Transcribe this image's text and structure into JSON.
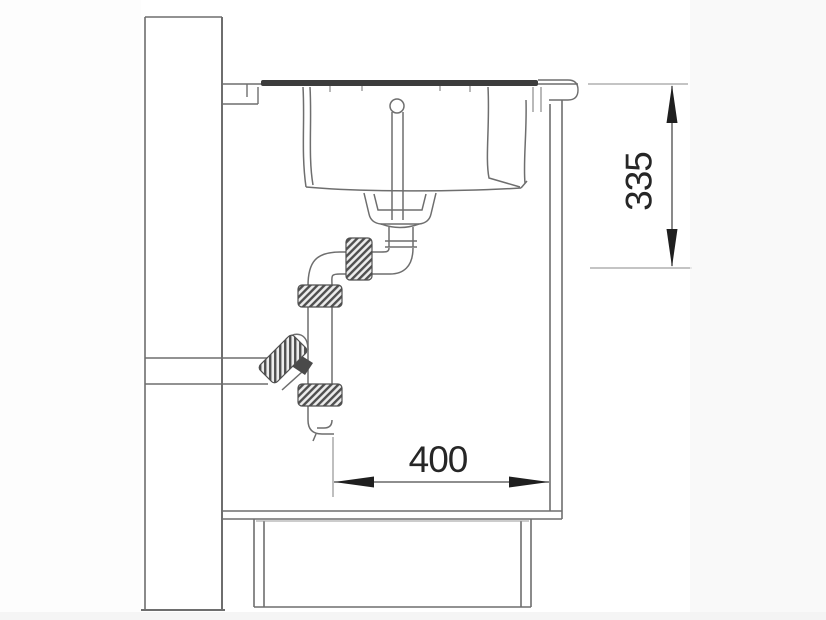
{
  "diagram": {
    "type": "kitchen-sink-installation-side-section",
    "dimensions": {
      "vertical_label": "335",
      "horizontal_label": "400"
    },
    "colors": {
      "background": "#ffffff",
      "line": "#6e6e6e",
      "dark_line": "#4a4a4a",
      "rim_fill": "#3c3c3c",
      "dimension_text": "#262626",
      "arrow_fill": "#1f1f1f"
    }
  }
}
